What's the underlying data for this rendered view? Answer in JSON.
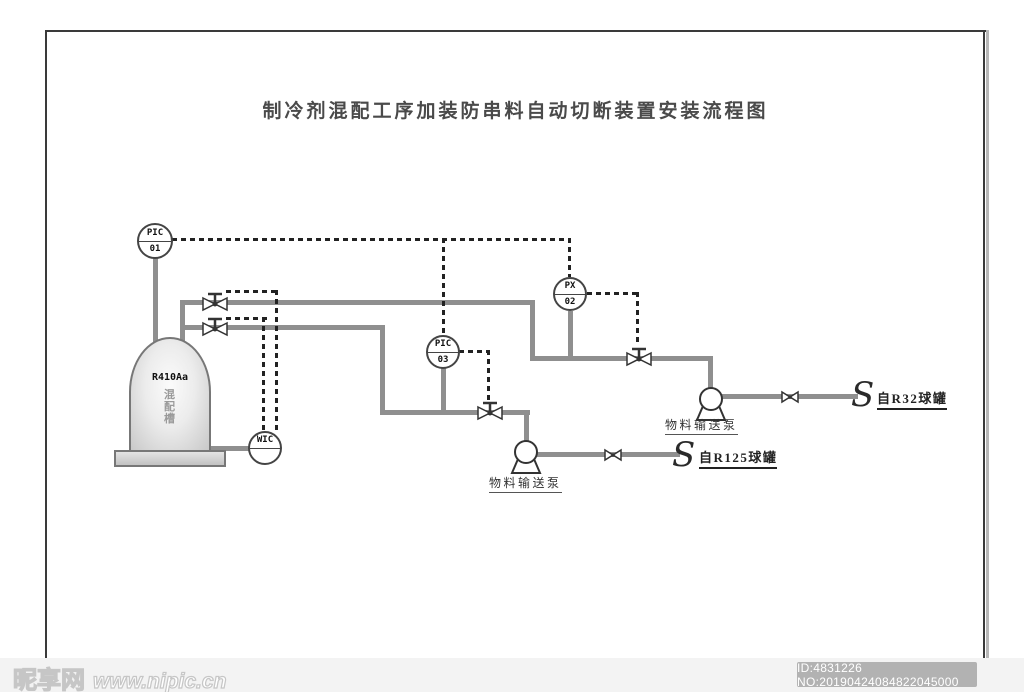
{
  "title": "制冷剂混配工序加装防串料自动切断装置安装流程图",
  "instruments": {
    "pic01": {
      "tag": "PIC",
      "num": "01"
    },
    "px02": {
      "tag": "PX",
      "num": "02"
    },
    "pic03": {
      "tag": "PIC",
      "num": "03"
    },
    "wic": {
      "tag": "WIC",
      "num": ""
    }
  },
  "tank": {
    "code": "R410Aa",
    "name": "混配槽"
  },
  "labels": {
    "pump_upper": "物料输送泵",
    "pump_lower": "物料输送泵",
    "source_upper": "自R32球罐",
    "source_lower": "自R125球罐",
    "break_symbol": "S"
  },
  "watermark": {
    "site": "昵享网",
    "url": "www.nipic.cn",
    "id": "ID:4831226 NO:20190424084822045000"
  },
  "colors": {
    "pipe": "#8f8f8f",
    "signal": "#222222",
    "outline": "#333333",
    "page_border": "#3a3a3a",
    "id_chip": "#b2b2b2"
  }
}
